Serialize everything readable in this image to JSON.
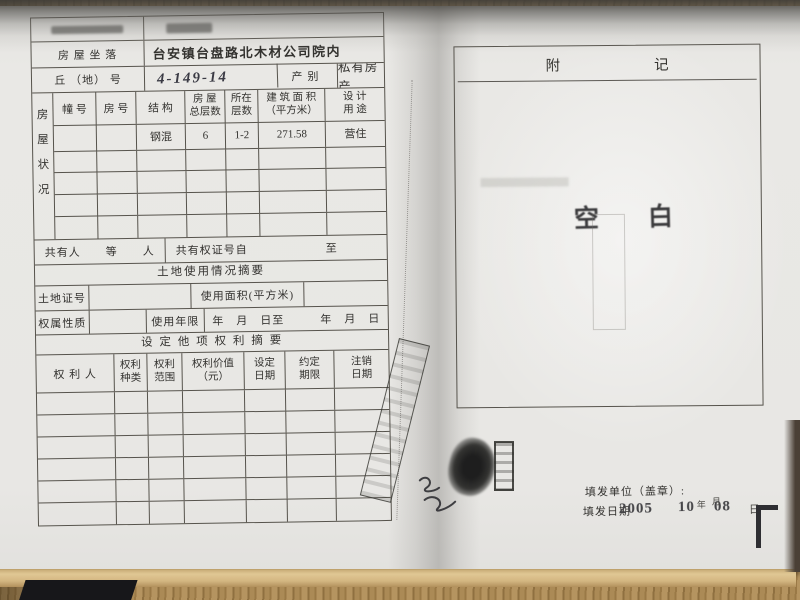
{
  "palette": {
    "paper": "#e8e7e4",
    "wood": "#a8874f",
    "ink": "#33322f",
    "stamp_ink": "#3b3b3d"
  },
  "left_page": {
    "location_label": "房 屋 坐 落",
    "location_value": "台安镇台盘路北木材公司院内",
    "plot_label": "丘 （地） 号",
    "plot_value": "4-149-14",
    "category_label": "产别",
    "category_value": "私有房产",
    "status_label": [
      "房",
      "屋",
      "状",
      "况"
    ],
    "housing_headers": {
      "c1": "幢 号",
      "c2": "房 号",
      "c3": "结 构",
      "c4a": "房 屋",
      "c4b": "总层数",
      "c5a": "所在",
      "c5b": "层数",
      "c6a": "建 筑 面 积",
      "c6b": "（平方米）",
      "c7a": "设 计",
      "c7b": "用 途"
    },
    "housing_row": {
      "structure": "钢混",
      "total_floors": "6",
      "floors_located": "1-2",
      "area": "271.58",
      "designed_use": "营住"
    },
    "co_owner": {
      "label": "共有人",
      "suffix": "等",
      "unit": "人",
      "cert_from": "共有权证号自",
      "to": "至"
    },
    "land_title": "土地使用情况摘要",
    "land_cert_label": "土地证号",
    "land_area_label": "使用面积(平方米)",
    "tenure_label": "权属性质",
    "years_label": "使用年限",
    "date_range": "年　月　日至　　　年　月　日",
    "rights_title": "设 定 他 项 权 利 摘 要",
    "rights_headers": {
      "c1": "权 利 人",
      "c2a": "权利",
      "c2b": "种类",
      "c3a": "权利",
      "c3b": "范围",
      "c4a": "权利价值",
      "c4b": "（元）",
      "c5a": "设定",
      "c5b": "日期",
      "c6a": "约定",
      "c6b": "期限",
      "c7a": "注销",
      "c7b": "日期"
    }
  },
  "right_page": {
    "title_char1": "附",
    "title_char2": "记",
    "blank_stamp": "空　白",
    "issuer_label": "填发单位（盖章）:",
    "date_label": "填发日期",
    "date_year": "2005",
    "year_char": "年",
    "date_month": "10",
    "month_char": "月",
    "date_day": "08",
    "day_char": "日"
  }
}
